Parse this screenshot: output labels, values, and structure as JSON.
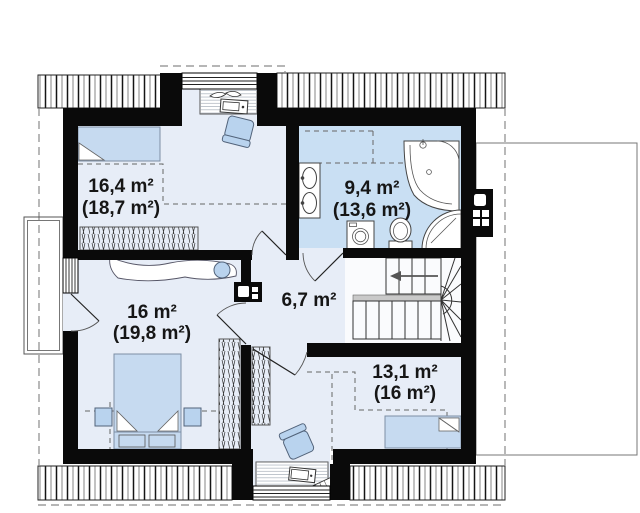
{
  "page": {
    "background": "#ffffff",
    "type": "floor-plan"
  },
  "colors": {
    "wall": "#0a0a0a",
    "floor": "#e7edf7",
    "bathroom_floor": "#c9dff3",
    "furniture_blue": "#b9d3ee",
    "bed_blue": "#c6daf0",
    "dash_gray": "#8a8a8a"
  },
  "rooms": [
    {
      "id": "bedroom-top-left",
      "area": "16,4 m²",
      "area_full": "(18,7 m²)"
    },
    {
      "id": "bathroom",
      "area": "9,4 m²",
      "area_full": "(13,6 m²)"
    },
    {
      "id": "bedroom-left",
      "area": "16 m²",
      "area_full": "(19,8 m²)"
    },
    {
      "id": "hallway",
      "area": "6,7 m²"
    },
    {
      "id": "bedroom-right",
      "area": "13,1 m²",
      "area_full": "(16 m²)"
    }
  ],
  "fixtures": [
    "single-bed",
    "writing-desk",
    "office-chair",
    "wardrobe",
    "dresser",
    "double-bed",
    "nightstand",
    "double-washbasin",
    "corner-bathtub",
    "washing-machine",
    "toilet",
    "shower-cabin",
    "winder-staircase",
    "chimney",
    "balcony",
    "window",
    "door",
    "roof-overhang"
  ]
}
